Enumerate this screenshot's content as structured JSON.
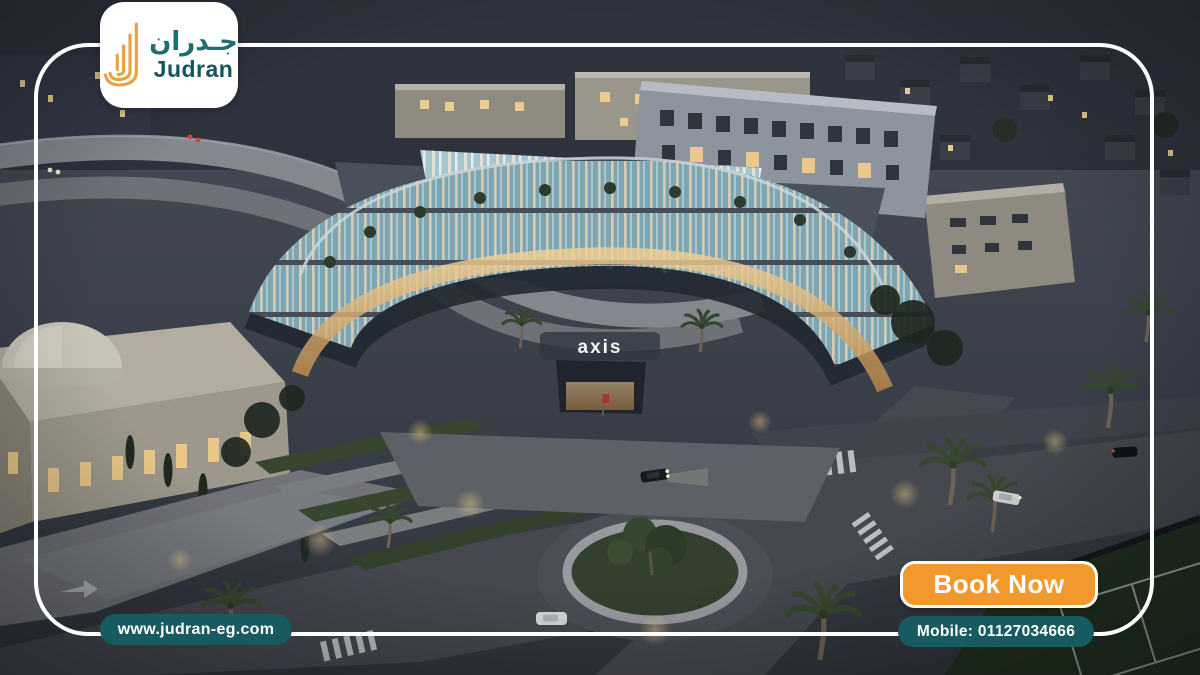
{
  "brand": {
    "name_ar": "جـدران",
    "name_en": "Judran",
    "logo_icon": "judran-walls-icon"
  },
  "badges": {
    "website": "www.judran-eg.com",
    "mobile": "Mobile: 01127034666"
  },
  "cta": {
    "book_label": "Book Now"
  },
  "scene": {
    "building_sign": "axis",
    "description_tags": [
      "aerial-night-render",
      "commercial-mall",
      "roundabout",
      "palm-trees",
      "dome-building"
    ]
  },
  "colors": {
    "accent_orange": "#F2992E",
    "badge_teal": "#175A60",
    "logo_teal": "#1D6D72",
    "frame_white": "#FFFFFF",
    "dusk_sky": "#4A4F5B"
  }
}
